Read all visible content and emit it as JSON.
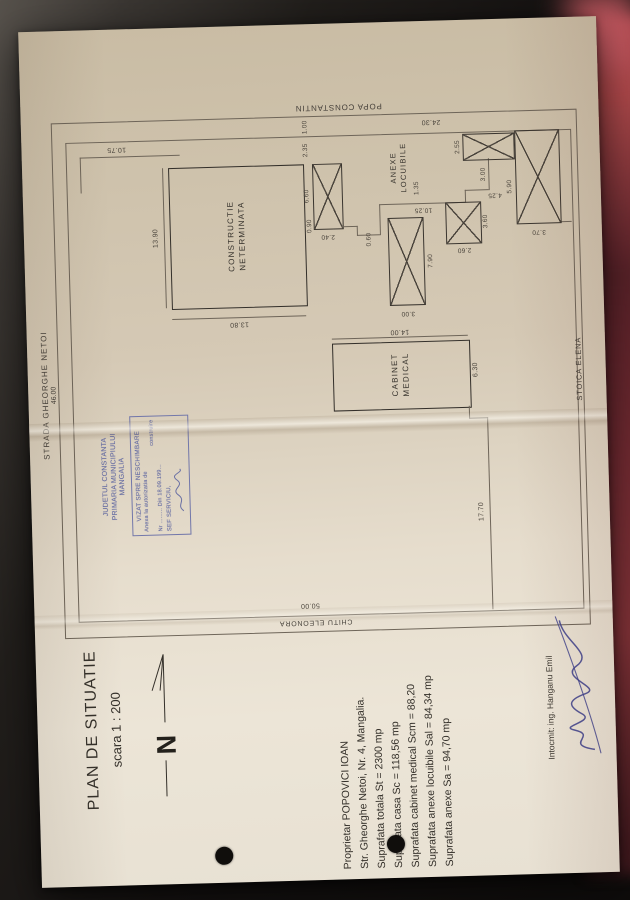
{
  "title_block": {
    "title": "PLAN DE SITUATIE",
    "scale": "scara 1 : 200",
    "north_letter": "N"
  },
  "owner_block": {
    "lines": [
      "Proprietar POPOVICI IOAN",
      "Str. Gheorghe Netoi, Nr. 4, Mangalia.",
      "Suprafata totala St = 2300 mp",
      "Suprafata casa Sc = 118,56 mp",
      "Suprafata cabinet medical Scm = 88,20",
      "Suprafata anexe locuibile Sal = 84,34 mp",
      "Suprafata anexe Sa = 94,70 mp"
    ]
  },
  "stamp": {
    "authority1": "JUDETUL CONSTANTA",
    "authority2": "PRIMARIA MUNICIPIULUI",
    "authority3": "MANGALIA",
    "box_title": "VIZAT SPRE NESCHIMBARE",
    "box_line1": "Anexa la autorizatia de",
    "box_line2": "construire",
    "box_line3": "Nr ......... Din 18.09.199...",
    "box_line4": "SEF SERVICIU,"
  },
  "author_block": {
    "label": "Intocmit: ing. Hanganu Emil"
  },
  "boundaries": {
    "street_top": "STRADA GHEORGHE NETOI",
    "street_top_dim": "46.00",
    "neighbor_left": "CHITU ELEONORA",
    "neighbor_left_dim": "50.00",
    "neighbor_bottom": "STOICA ELENA",
    "neighbor_right": "POPA CONSTANTIN"
  },
  "buildings": {
    "construction": {
      "line1": "CONSTRUCTIE",
      "line2": "NETERMINATA",
      "width": "13.80",
      "height": "13.90"
    },
    "annex": {
      "line1": "ANEXE",
      "line2": "LOCUIBILE"
    },
    "cabinet": {
      "line1": "CABINET",
      "line2": "MEDICAL",
      "width": "14.00",
      "height": "6.30"
    }
  },
  "dims": {
    "d10_75": "10.75",
    "d24_30": "24.30",
    "d1_00": "1.00",
    "d2_35": "2.35",
    "d6_60": "6.60",
    "d0_90": "0.90",
    "d2_40": "2.40",
    "d0_60": "0.60",
    "d10_25": "10.25",
    "d1_35": "1.35",
    "d7_90": "7.90",
    "d3_00": "3.00",
    "d2_60": "2.60",
    "d3_60": "3.60",
    "d2_55": "2.55",
    "d3_00b": "3.00",
    "d4_25": "4.25",
    "d5_90": "5.90",
    "d3_70": "3.70",
    "d13_90": "13.90",
    "d13_80": "13.80",
    "d14_00": "14.00",
    "d6_30": "6.30",
    "d17_70": "17.70"
  },
  "colors": {
    "paper": "#e3dac9",
    "ink": "#3a352f",
    "stamp_ink": "#6a70a4",
    "signature_ink": "#3b3e8c",
    "fabric_red": "#8a2f3a"
  }
}
